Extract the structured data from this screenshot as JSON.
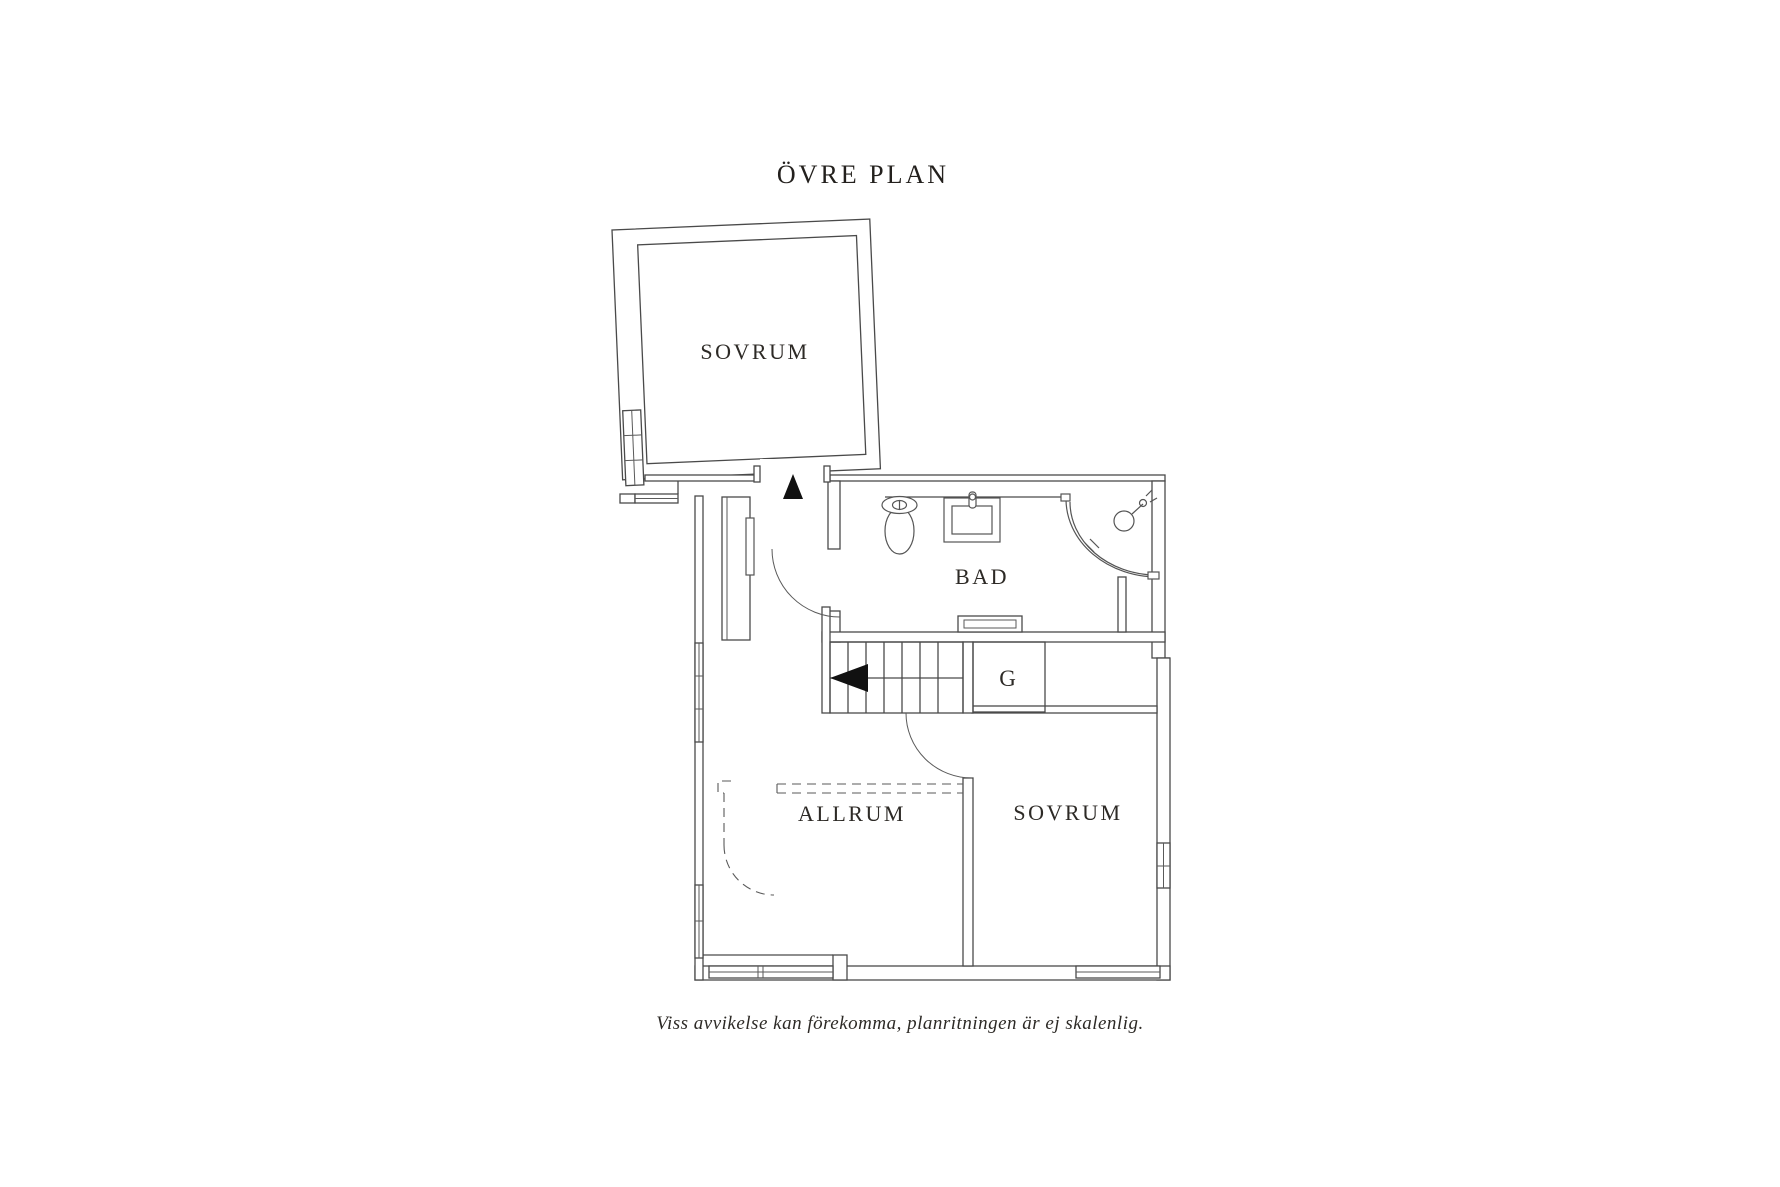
{
  "title": "ÖVRE PLAN",
  "caption": "Viss avvikelse kan förekomma, planritningen är ej skalenlig.",
  "rooms": {
    "sovrum_upper": "SOVRUM",
    "bad": "BAD",
    "garderob": "G",
    "allrum": "ALLRUM",
    "sovrum_lower": "SOVRUM"
  },
  "symbols": {
    "entry_arrow": "up-arrow",
    "stair_arrow": "left-arrow"
  },
  "colors": {
    "background": "#ffffff",
    "wall_line": "#4a4a4a",
    "fixture_line": "#555555",
    "text": "#2d2a26",
    "arrow": "#111111"
  }
}
